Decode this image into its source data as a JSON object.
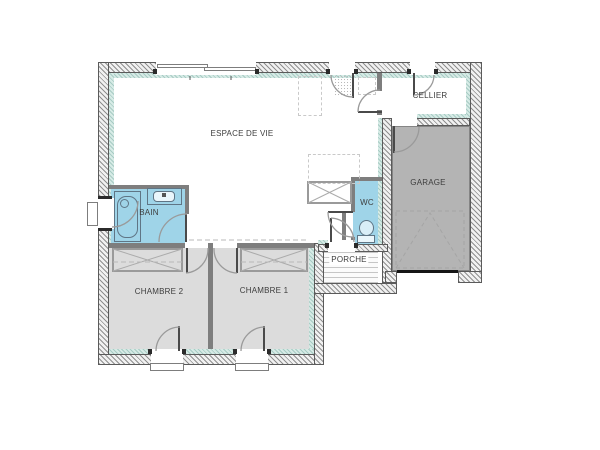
{
  "rooms": [
    {
      "id": "espace-de-vie",
      "label": "ESPACE DE VIE"
    },
    {
      "id": "cellier",
      "label": "CELLIER"
    },
    {
      "id": "garage",
      "label": "GARAGE"
    },
    {
      "id": "bain",
      "label": "BAIN"
    },
    {
      "id": "wc",
      "label": "WC"
    },
    {
      "id": "porche",
      "label": "PORCHE"
    },
    {
      "id": "chambre-2",
      "label": "CHAMBRE 2"
    },
    {
      "id": "chambre-1",
      "label": "CHAMBRE 1"
    }
  ],
  "colors": {
    "wet_room": "#9fd4e8",
    "bedroom_floor": "#dcdcdc",
    "garage_floor": "#b4b4b4",
    "insulation": "#d7ebe6",
    "hatch_line": "#8f8f8f",
    "hatch_bg": "#f1f1f1",
    "partition": "#7e7e7e",
    "fixture_line": "#5f7585",
    "arc_line": "#9a9a9a",
    "label_text": "#3d3d3d"
  }
}
